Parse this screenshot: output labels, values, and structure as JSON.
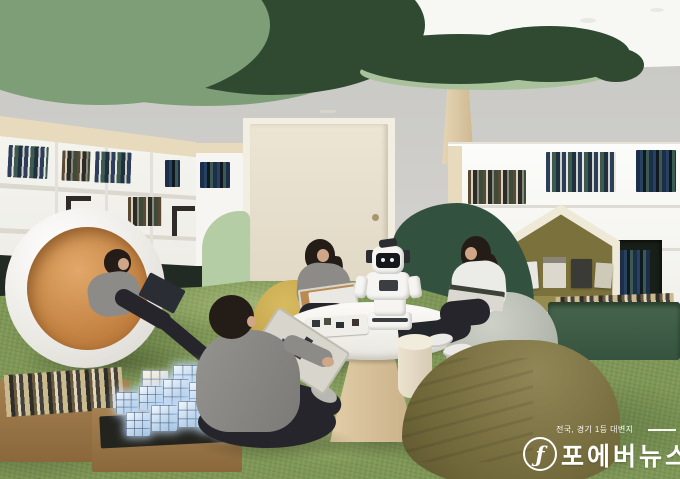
{
  "alt": "Rendering of a children's library lounge: green cloud ceiling panels, a tree-shaped column, white bookshelves, a house-shaped reading nook, a round pod chair, kids reading on bean bags around a white table with a small humanoid robot, glowing block cubes on the grass-like carpet.",
  "watermark": {
    "tagline": "전국, 경기 1등 대변지",
    "title": "포에버뉴스",
    "logo_glyph": "ƒ",
    "color": "#ffffff"
  },
  "palette": {
    "ceiling": "#f7f7f4",
    "wall": "#c9c9c5",
    "cloud-dark": "#2f4a31",
    "cloud-sage": "#7d9e77",
    "canopy-underside": "#a9c29c",
    "trunk": "#dccaa9",
    "shelf-wood": "#e8dabc",
    "shelf-dark": "#222b23",
    "door": "#e8e1d1",
    "partition-light": "#b5cda5",
    "partition-dark": "#33513f",
    "nook-olive": "#7b713c",
    "grass": "#7e9655",
    "pod-interior": "#c07f3f",
    "table-top": "#e8e6e0",
    "beanbag-mustard": "#b3923c",
    "beanbag-gray": "#a2a79d",
    "beanbag-olive": "#6f6639",
    "box-green": "#35533e",
    "cube-glow": "#cfe4f8",
    "skin": "#cfa687",
    "hair": "#241c17",
    "shirt-gray": "#8c8b87",
    "shirt-white": "#ebebe8",
    "pants-dark": "#25252b"
  }
}
